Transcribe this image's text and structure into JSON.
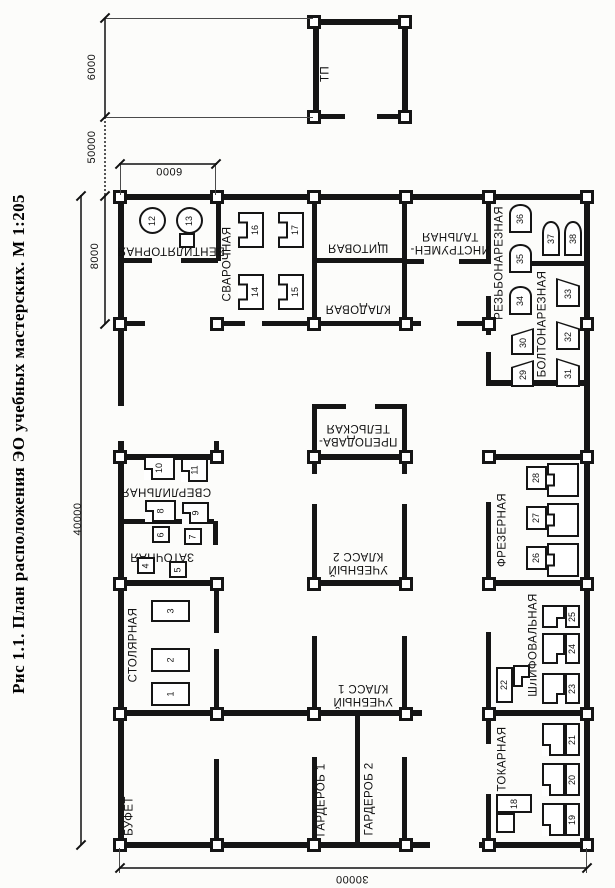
{
  "figure": {
    "caption": "Рис 1.1. План расположения ЭО учебных мастерских. М 1:205"
  },
  "dimensions": {
    "tp_width": "6000",
    "tp_to_building": "50000",
    "bay_width": "6000",
    "wing_depth": "8000",
    "building_length": "40000",
    "building_width": "30000"
  },
  "buildings": {
    "tp": "ТП"
  },
  "rooms": {
    "ventilatornaya": "ВЕНТИЛЯТОРНАЯ",
    "svarochnaya": "СВАРОЧНАЯ",
    "shchitovaya": "ЩИТОВАЯ",
    "kladovaya": "КЛАДОВАЯ",
    "instrumentalnaya": {
      "line1": "ИНСТРУМЕН-",
      "line2": "ТАЛЬНАЯ"
    },
    "rezbonareznaya": "РЕЗЬБОНАРЕЗНАЯ",
    "boltonareznaya": "БОЛТОНАРЕЗНАЯ",
    "prepodavatelskaya": {
      "line1": "ПРЕПОДАВА-",
      "line2": "ТЕЛЬСКАЯ"
    },
    "klass2": {
      "line1": "УЧЕБНЫЙ",
      "line2": "КЛАСС 2"
    },
    "klass1": {
      "line1": "УЧЕБНЫЙ",
      "line2": "КЛАСС 1"
    },
    "sverlilnaya": "СВЕРЛИЛЬНАЯ",
    "zatochnaya": "ЗАТОЧНАЯ",
    "stolyarnaya": "СТОЛЯРНАЯ",
    "bufet": "БУФЕТ",
    "garderob1": "ГАРДЕРОБ 1",
    "garderob2": "ГАРДЕРОБ 2",
    "frezernaya": "ФРЕЗЕРНАЯ",
    "shlifovalnaya": "ШЛИФОВАЛЬНАЯ",
    "tokarnaya": "ТОКАРНАЯ"
  },
  "machines": {
    "m1": "1",
    "m2": "2",
    "m3": "3",
    "m4": "4",
    "m5": "5",
    "m6": "6",
    "m7": "7",
    "m8": "8",
    "m9": "9",
    "m10": "10",
    "m11": "11",
    "m12": "12",
    "m13": "13",
    "m14": "14",
    "m15": "15",
    "m16": "16",
    "m17": "17",
    "m18": "18",
    "m19": "19",
    "m20": "20",
    "m21": "21",
    "m22": "22",
    "m23": "23",
    "m24": "24",
    "m25": "25",
    "m26": "26",
    "m27": "27",
    "m28": "28",
    "m29": "29",
    "m30": "30",
    "m31": "31",
    "m32": "32",
    "m33": "33",
    "m34": "34",
    "m35": "35",
    "m36": "36",
    "m37": "37",
    "m38": "38"
  }
}
